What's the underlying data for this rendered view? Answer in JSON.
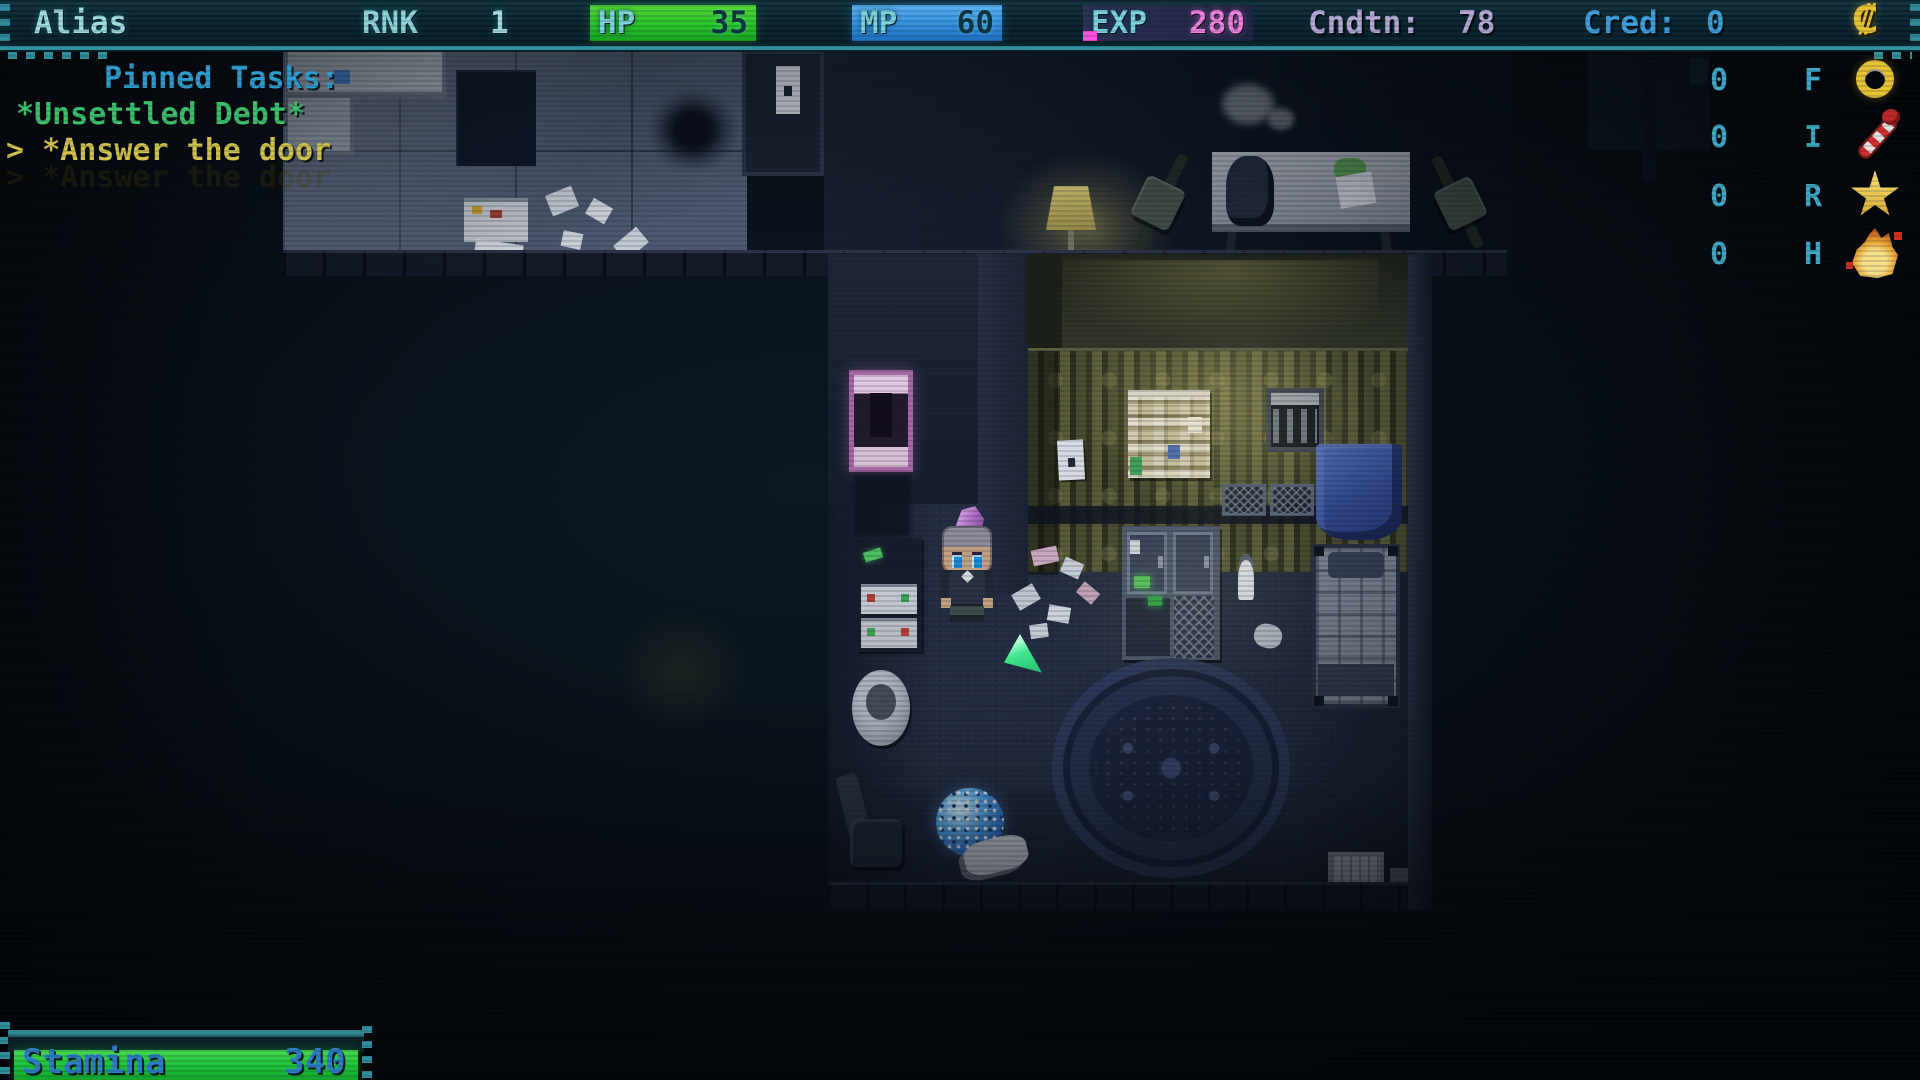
{
  "hud": {
    "top_bar": {
      "alias": "Alias",
      "rank_label": "RNK",
      "rank_value": "1",
      "hp_label": "HP",
      "hp_value": "35",
      "mp_label": "MP",
      "mp_value": "60",
      "exp_label": "EXP",
      "exp_value": "280",
      "condition_label": "Cndtn:",
      "condition_value": "78",
      "credits_label": "Cred:",
      "credits_value": "0",
      "currency_glyph": "₡"
    },
    "pinned_tasks": {
      "title": "Pinned Tasks:",
      "tasks": [
        {
          "label": "*Unsettled Debt*"
        },
        {
          "label": "> *Answer the door"
        }
      ]
    },
    "counters": [
      {
        "value": "0",
        "letter": "F",
        "icon": "ring-icon"
      },
      {
        "value": "0",
        "letter": "I",
        "icon": "wand-icon"
      },
      {
        "value": "0",
        "letter": "R",
        "icon": "star-icon"
      },
      {
        "value": "0",
        "letter": "H",
        "icon": "flame-icon"
      }
    ],
    "stamina": {
      "label": "Stamina",
      "value": "340"
    }
  },
  "colors": {
    "frame_teal": "#2f8e9a",
    "hud_cyan": "#8fd4d8",
    "task_title_blue": "#2f9cd0",
    "task_green": "#3cc06c",
    "task_yellow": "#d2c24c",
    "hp_green": "#28c42a",
    "mp_blue": "#3390dd",
    "exp_pink": "#ee82dd",
    "exp_chip_magenta": "#ff4fe0",
    "condition_lavender": "#b4a8d4",
    "credits_blue": "#3fa0dc",
    "stamina_green": "#1ec43c",
    "stamina_text_blue": "#2e7fc8",
    "gold": "#e6c235",
    "cursor_green": "#46e690"
  }
}
